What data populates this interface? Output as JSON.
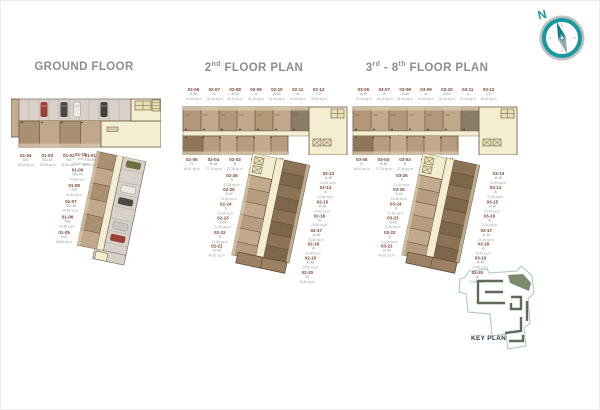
{
  "compass": {
    "north_label": "N",
    "accent": "#1898a0"
  },
  "key_plan": {
    "label": "KEY PLAN"
  },
  "plans": {
    "ground": {
      "title": "GROUND FLOOR",
      "bar_labels": [
        {
          "no": "01-04",
          "type": "DG",
          "area": "48.88 sq.m"
        },
        {
          "no": "01-03",
          "type": "SG-M",
          "area": "34.88 sq.m"
        },
        {
          "no": "01-02",
          "type": "SG",
          "area": "34.88 sq.m"
        },
        {
          "no": "01-01",
          "type": "RG-M",
          "area": "34.88 sq.m"
        }
      ],
      "wing_labels": [
        {
          "no": "01-10",
          "type": "SG",
          "area": "34.88 sq.m"
        },
        {
          "no": "01-09",
          "type": "SG-M",
          "area": "34.88 sq.m"
        },
        {
          "no": "01-08",
          "type": "SG",
          "area": "34.88 sq.m"
        },
        {
          "no": "01-07",
          "type": "SG-M",
          "area": "34.88 sq.m"
        },
        {
          "no": "01-06",
          "type": "SG",
          "area": "34.88 sq.m"
        },
        {
          "no": "01-05",
          "type": "DG",
          "area": "48.88 sq.m"
        }
      ]
    },
    "second": {
      "title_a": "2",
      "sup_a": "nd",
      "title_b": "",
      "sup_b": "",
      "title_c": " FLOOR PLAN",
      "top_labels": [
        {
          "no": "02-06",
          "type": "A-M",
          "area": "24.46 sq.m"
        },
        {
          "no": "02-07",
          "type": "A",
          "area": "24.46 sq.m"
        },
        {
          "no": "02-08",
          "type": "A-M",
          "area": "24.46 sq.m"
        },
        {
          "no": "02-09",
          "type": "A",
          "area": "24.46 sq.m"
        },
        {
          "no": "02-10",
          "type": "A-M",
          "area": "24.46 sq.m"
        },
        {
          "no": "02-11",
          "type": "A",
          "area": "24.46 sq.m"
        },
        {
          "no": "02-12",
          "type": "C2",
          "area": "34.89 sq.m"
        }
      ],
      "bottom_labels": [
        {
          "no": "02-05",
          "type": "D",
          "area": "46.61 sq.m"
        },
        {
          "no": "02-04",
          "type": "B-M",
          "area": "27.38 sq.m"
        },
        {
          "no": "02-03",
          "type": "B",
          "area": "27.38 sq.m"
        },
        {
          "no": "02-02",
          "type": "B-M",
          "area": "27.38 sq.m"
        },
        {
          "no": "02-01",
          "type": "B",
          "area": "27.38 sq.m"
        }
      ],
      "wing_right_labels": [
        {
          "no": "02-13",
          "type": "A-M",
          "area": "24.46 sq.m"
        },
        {
          "no": "02-14",
          "type": "A",
          "area": "24.46 sq.m"
        },
        {
          "no": "02-15",
          "type": "A-M",
          "area": "24.46 sq.m"
        },
        {
          "no": "02-16",
          "type": "A",
          "area": "24.46 sq.m"
        },
        {
          "no": "02-17",
          "type": "A-M",
          "area": "24.46 sq.m"
        },
        {
          "no": "02-18",
          "type": "A",
          "area": "24.46 sq.m"
        },
        {
          "no": "02-19",
          "type": "A-M",
          "area": "24.46 sq.m"
        },
        {
          "no": "02-20",
          "type": "A",
          "area": "24.46 sq.m"
        }
      ],
      "wing_left_labels": [
        {
          "no": "02-26",
          "type": "S",
          "area": "21.84 sq.m"
        },
        {
          "no": "02-25",
          "type": "S-M",
          "area": "21.84 sq.m"
        },
        {
          "no": "02-24",
          "type": "S",
          "area": "21.84 sq.m"
        },
        {
          "no": "02-23",
          "type": "S-M",
          "area": "21.84 sq.m"
        },
        {
          "no": "02-22",
          "type": "S",
          "area": "21.84 sq.m"
        },
        {
          "no": "02-21",
          "type": "D-M",
          "area": "40.61 sq.m"
        }
      ]
    },
    "third": {
      "title_a": "3",
      "sup_a": "rd",
      "title_b": " - 8",
      "sup_b": "th",
      "title_c": " FLOOR PLAN",
      "top_labels": [
        {
          "no": "03-06",
          "type": "A-M",
          "area": "24.46 sq.m"
        },
        {
          "no": "03-07",
          "type": "A",
          "area": "24.46 sq.m"
        },
        {
          "no": "03-08",
          "type": "A-M",
          "area": "24.46 sq.m"
        },
        {
          "no": "03-09",
          "type": "A",
          "area": "24.46 sq.m"
        },
        {
          "no": "03-10",
          "type": "A-M",
          "area": "24.46 sq.m"
        },
        {
          "no": "03-11",
          "type": "A",
          "area": "24.46 sq.m"
        },
        {
          "no": "03-12",
          "type": "C2",
          "area": "34.89 sq.m"
        }
      ],
      "bottom_labels": [
        {
          "no": "03-05",
          "type": "D",
          "area": "46.61 sq.m"
        },
        {
          "no": "03-04",
          "type": "B-M",
          "area": "27.38 sq.m"
        },
        {
          "no": "03-03",
          "type": "B",
          "area": "27.38 sq.m"
        },
        {
          "no": "03-02",
          "type": "B-M",
          "area": "27.38 sq.m"
        },
        {
          "no": "03-01",
          "type": "B",
          "area": "27.38 sq.m"
        }
      ],
      "wing_right_labels": [
        {
          "no": "03-13",
          "type": "A-M",
          "area": "24.46 sq.m"
        },
        {
          "no": "03-14",
          "type": "A",
          "area": "24.46 sq.m"
        },
        {
          "no": "03-15",
          "type": "A-M",
          "area": "24.46 sq.m"
        },
        {
          "no": "03-16",
          "type": "A",
          "area": "24.46 sq.m"
        },
        {
          "no": "03-17",
          "type": "A-M",
          "area": "24.46 sq.m"
        },
        {
          "no": "03-18",
          "type": "A",
          "area": "24.46 sq.m"
        },
        {
          "no": "03-19",
          "type": "A-M",
          "area": "24.46 sq.m"
        },
        {
          "no": "03-20",
          "type": "A",
          "area": "24.46 sq.m"
        }
      ],
      "wing_left_labels": [
        {
          "no": "03-26",
          "type": "S",
          "area": "21.84 sq.m"
        },
        {
          "no": "03-25",
          "type": "S-M",
          "area": "21.84 sq.m"
        },
        {
          "no": "03-24",
          "type": "S",
          "area": "21.84 sq.m"
        },
        {
          "no": "03-23",
          "type": "S-M",
          "area": "21.84 sq.m"
        },
        {
          "no": "03-22",
          "type": "S",
          "area": "21.84 sq.m"
        },
        {
          "no": "03-21",
          "type": "D-M",
          "area": "40.61 sq.m"
        }
      ]
    }
  }
}
